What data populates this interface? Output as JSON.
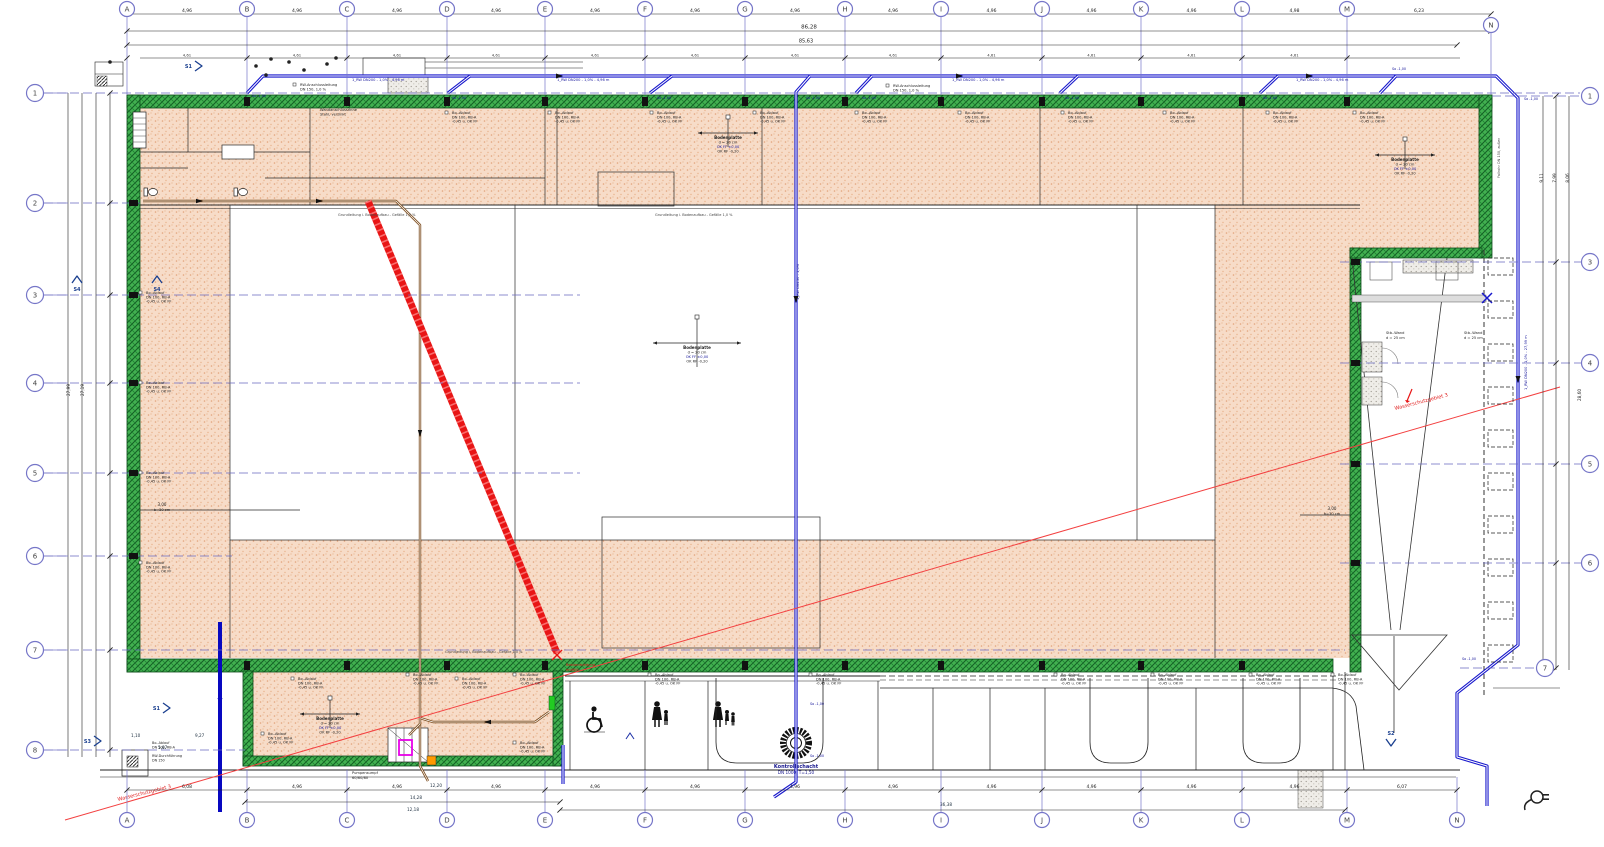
{
  "palette": {
    "wall_green": "#3fae4c",
    "wall_hatch": "#19702c",
    "floor_pink": "#f7dcc8",
    "floor_dot": "#e2a37c",
    "pipe_blue": "#1818cc",
    "pipe_brown": "#7c4c1d",
    "red": "#e81515",
    "red_thin": "#f34040",
    "grid_blue": "#7676c8",
    "ink": "#1a1a1a",
    "note_blue": "#15159a",
    "magenta": "#e800e8",
    "orange": "#ff9900",
    "door_green": "#22cc22"
  },
  "grid": {
    "columns": [
      [
        "A",
        127
      ],
      [
        "B",
        247
      ],
      [
        "C",
        347
      ],
      [
        "D",
        447
      ],
      [
        "E",
        545
      ],
      [
        "F",
        645
      ],
      [
        "G",
        745
      ],
      [
        "H",
        845
      ],
      [
        "I",
        941
      ],
      [
        "J",
        1042
      ],
      [
        "K",
        1141
      ],
      [
        "L",
        1242
      ],
      [
        "M",
        1347
      ]
    ],
    "column_n": {
      "label": "N",
      "x_bottom": 1457,
      "x_top": 1491,
      "y_top": 25
    },
    "rows_left": [
      [
        "1",
        93
      ],
      [
        "2",
        203
      ],
      [
        "3",
        295
      ],
      [
        "4",
        383
      ],
      [
        "5",
        473
      ],
      [
        "6",
        556
      ],
      [
        "7",
        650
      ],
      [
        "8",
        750
      ]
    ],
    "rows_right": [
      [
        "1",
        96
      ],
      [
        "3",
        262
      ],
      [
        "4",
        363
      ],
      [
        "5",
        464
      ],
      [
        "6",
        563
      ],
      [
        "7",
        668
      ]
    ]
  },
  "dimensions": {
    "top_spans": [
      "4,96",
      "4,96",
      "4,96",
      "4,96",
      "4,96",
      "4,96",
      "4,96",
      "4,96",
      "4,96",
      "4,96",
      "4,96",
      "4,98"
    ],
    "span_mn": "6,23",
    "sub_span": "4,61",
    "overall_top_1": "86,28",
    "overall_top_2": "85,63",
    "bottom_spans": [
      "6,08",
      "4,96",
      "4,96",
      "4,96",
      "4,96",
      "4,96",
      "4,96",
      "4,96",
      "4,96",
      "4,96",
      "4,96",
      "4,96"
    ],
    "span_mn_bottom": "6,07",
    "left_rot": [
      {
        "t": "27,99",
        "x": 70,
        "y": 390
      },
      {
        "t": "27,19",
        "x": 84,
        "y": 390
      }
    ],
    "right_rot": [
      {
        "t": "9,11",
        "x": 1543,
        "y": 178
      },
      {
        "t": "7,99",
        "x": 1556,
        "y": 178
      },
      {
        "t": "8,06",
        "x": 1569,
        "y": 178
      },
      {
        "t": "28,60",
        "x": 1581,
        "y": 395
      }
    ],
    "extra_dims": [
      {
        "t": "1,10",
        "x": 131,
        "y": 737
      },
      {
        "t": "9,27",
        "x": 195,
        "y": 737
      },
      {
        "t": "5,87",
        "x": 158,
        "y": 749
      },
      {
        "t": "14,28",
        "x": 410,
        "y": 799
      },
      {
        "t": "12,18",
        "x": 407,
        "y": 811
      },
      {
        "t": "36,38",
        "x": 940,
        "y": 806
      },
      {
        "t": "12,20",
        "x": 430,
        "y": 787
      }
    ],
    "strip_w": "3,00",
    "strip_d": "b=30 cm"
  },
  "annotations": {
    "bodenplatte": {
      "l1": "Bodenplatte",
      "l2": "d = 20 cm",
      "l3": "OK FF ±0,00",
      "l4": "OK RF -0,20"
    },
    "bodenplatte_pos": [
      {
        "x": 697,
        "y": 343,
        "small": false
      },
      {
        "x": 728,
        "y": 133,
        "small": true
      },
      {
        "x": 1405,
        "y": 155,
        "small": true
      },
      {
        "x": 330,
        "y": 714,
        "small": true
      }
    ],
    "kontrollschacht": {
      "l1": "Kontrollschacht",
      "l2": "DN 1000, T=1,50"
    },
    "wasserschutzgebiet": "Wasserschutzgebiet 3",
    "bestand": {
      "l1": "Bestandsleitung",
      "l2": "entfällt"
    },
    "drain_note": {
      "l1": "Bo.-Ablauf",
      "l2": "DN 100, RB-A",
      "l3": "-0,45 u. OK FF"
    },
    "drain_positions": {
      "top": [
        452,
        555,
        657,
        760,
        862,
        965,
        1068,
        1170,
        1273,
        1360
      ],
      "top_y": 112,
      "left_x": 146,
      "left": [
        292,
        382,
        472,
        562
      ],
      "bottom": [
        413,
        520,
        655,
        816,
        1061,
        1158,
        1256,
        1338
      ],
      "bottom_y": 674,
      "annex": [
        [
          298,
          678
        ],
        [
          462,
          678
        ],
        [
          268,
          733
        ],
        [
          520,
          742
        ]
      ]
    },
    "rw_note": {
      "l1": "RW-Anschlussleitung",
      "l2": "DN 150, 1,0 %"
    },
    "rw_positions": [
      [
        300,
        84
      ],
      [
        893,
        85
      ]
    ],
    "wand_note": {
      "l1": "Wandanschlussrinne",
      "l2": "Stahl, verzinkt"
    },
    "grund_note": "Grundleitung i. Bodenaufbau - Gefälle 1,0 %",
    "durch_note": {
      "l1": "RW-Durchführung",
      "l2": "DN 150"
    },
    "pump_note": {
      "l1": "Pumpensumpf",
      "l2": "60/60/80"
    },
    "ramp_wall_note": {
      "l1": "Stb.-Wand",
      "l2": "d = 25 cm"
    },
    "fallrohr_note": "Fallrohr DN 150, außen",
    "pipe_label": "1_RW DN200 - 1,0% - 4,96 m",
    "pipe_label_positions": [
      352,
      557,
      952,
      1296
    ],
    "pipe_label_v": "1_RW DN150 - 1,0%",
    "pipe_label_right": "1_RW DN200 - 1,0% - 27,99 m",
    "so_label": "So -1,00",
    "so_positions": [
      [
        252,
        97
      ],
      [
        452,
        99
      ],
      [
        657,
        99
      ],
      [
        806,
        99
      ],
      [
        862,
        99
      ],
      [
        1065,
        99
      ],
      [
        1263,
        99
      ],
      [
        1392,
        70
      ],
      [
        1524,
        100
      ],
      [
        810,
        705
      ],
      [
        810,
        757
      ],
      [
        1462,
        660
      ]
    ],
    "section_markers": [
      {
        "label": "S1",
        "x": 200,
        "y": 66,
        "dir": "e"
      },
      {
        "label": "S1",
        "x": 168,
        "y": 708,
        "dir": "e"
      },
      {
        "label": "S3",
        "x": 99,
        "y": 741,
        "dir": "e"
      },
      {
        "label": "S4",
        "x": 77,
        "y": 280,
        "dir": "n"
      },
      {
        "label": "S4",
        "x": 157,
        "y": 280,
        "dir": "n"
      },
      {
        "label": "S2",
        "x": 1391,
        "y": 742,
        "dir": "s"
      }
    ]
  }
}
